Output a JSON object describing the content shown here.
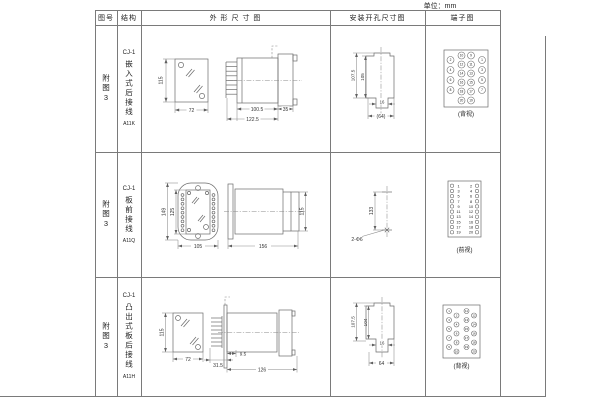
{
  "unit_label": "单位：mm",
  "colors": {
    "line": "#6b6b6b",
    "text": "#333333",
    "background": "#ffffff"
  },
  "headers": {
    "fig_no": "图号",
    "structure": "结构",
    "outline": "外 形 尺 寸 图",
    "install": "安装开孔尺寸图",
    "terminal": "端子图"
  },
  "rows": [
    {
      "fig_no": "附图3",
      "model": "CJ-1",
      "mount": "嵌入式后接线",
      "code": "A11K",
      "outline": {
        "front_height": "115",
        "front_width": "72",
        "body_length": "100.5",
        "total_length": "122.5",
        "flange_depth": "35"
      },
      "install": {
        "cutout_height_outer": "107.5",
        "cutout_height_inner": "105",
        "slot_width": "16",
        "cutout_width": "(64)"
      },
      "terminal": {
        "caption": "(背视)",
        "outer_left": [
          "2",
          "4",
          "6",
          "8"
        ],
        "outer_right": [
          "1",
          "3",
          "5",
          "7"
        ],
        "mid_left": [
          "10",
          "12",
          "14",
          "16",
          "18",
          "20"
        ],
        "mid_right": [
          "9",
          "11",
          "13",
          "15",
          "17",
          "19"
        ]
      }
    },
    {
      "fig_no": "附图3",
      "model": "CJ-1",
      "mount": "板前接线",
      "code": "A11Q",
      "outline": {
        "front_height_outer": "149",
        "front_height_inner": "125",
        "front_width": "105",
        "side_length": "156",
        "side_height": "115"
      },
      "install": {
        "hole_spacing": "133",
        "holes": "2-Φ6"
      },
      "terminal": {
        "caption": "(前视)",
        "left": [
          "1",
          "3",
          "5",
          "7",
          "9",
          "11",
          "13",
          "15",
          "17",
          "19"
        ],
        "right": [
          "2",
          "4",
          "6",
          "8",
          "10",
          "12",
          "14",
          "16",
          "18",
          "20"
        ]
      }
    },
    {
      "fig_no": "附图3",
      "model": "CJ-1",
      "mount": "凸出式板后接线",
      "code": "A11H",
      "outline": {
        "front_height": "115",
        "front_width": "72",
        "fin_depth": "31.5",
        "panel_gap": "9.5",
        "body_length": "126"
      },
      "install": {
        "cutout_height_outer": "107.5",
        "cutout_height_inner": "104",
        "slot_width": "16",
        "cutout_width": "64"
      },
      "terminal": {
        "caption": "(背视)",
        "col_a": [
          "1",
          "3",
          "5",
          "7",
          "9"
        ],
        "col_b": [
          "2",
          "4",
          "6",
          "8",
          "10"
        ],
        "col_c": [
          "11",
          "13",
          "15",
          "17",
          "19"
        ],
        "col_d": [
          "12",
          "14",
          "16",
          "18",
          "20"
        ]
      }
    }
  ]
}
